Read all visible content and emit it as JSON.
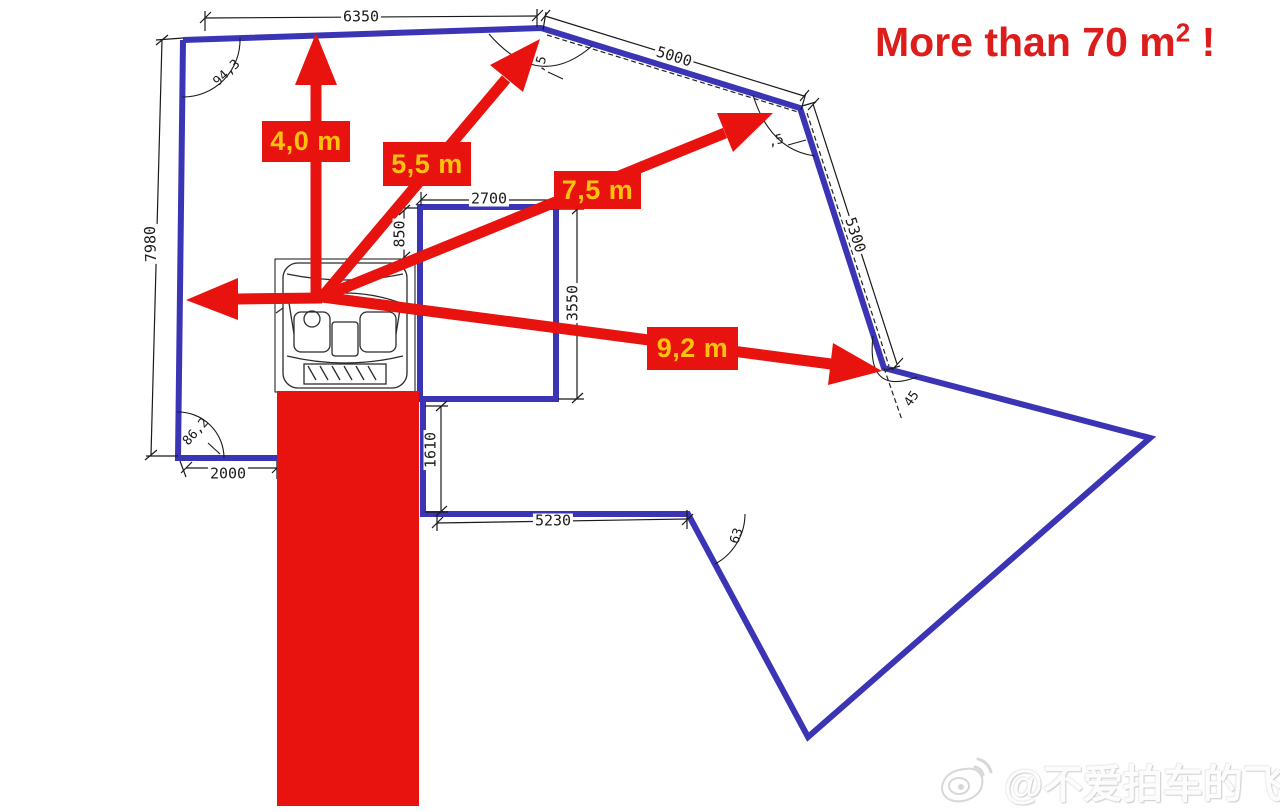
{
  "title": {
    "text": "More than 70 m",
    "sup": "2",
    "suffix": " !"
  },
  "arrow_labels": {
    "up": "4,0 m",
    "upper_right": "5,5 m",
    "right_upper": "7,5 m",
    "right": "9,2 m"
  },
  "dims": {
    "top": "6350",
    "upper_right": "5000",
    "right_side": "5300",
    "left_side": "7980",
    "bottom_left": "2000",
    "inner_top": "2700",
    "inner_left": "850",
    "inner_right": "3550",
    "inner_vertical": "1610",
    "bottom": "5230"
  },
  "angles": {
    "top_left": "94,3",
    "bottom_left": "86,2",
    "bottom_middle": "63",
    "top_corner": ",5",
    "upper_right_corner": ",5",
    "right_corner": "45"
  },
  "watermark": {
    "handle": "@不爱拍车的飞机",
    "icon": "weibo-logo"
  },
  "colors": {
    "boundary_blue": "#3b35b5",
    "highlight_red": "#e8120f",
    "label_yellow": "#ffc20d",
    "title_red": "#dd1c1c",
    "cad_line": "#1a1a1a"
  }
}
